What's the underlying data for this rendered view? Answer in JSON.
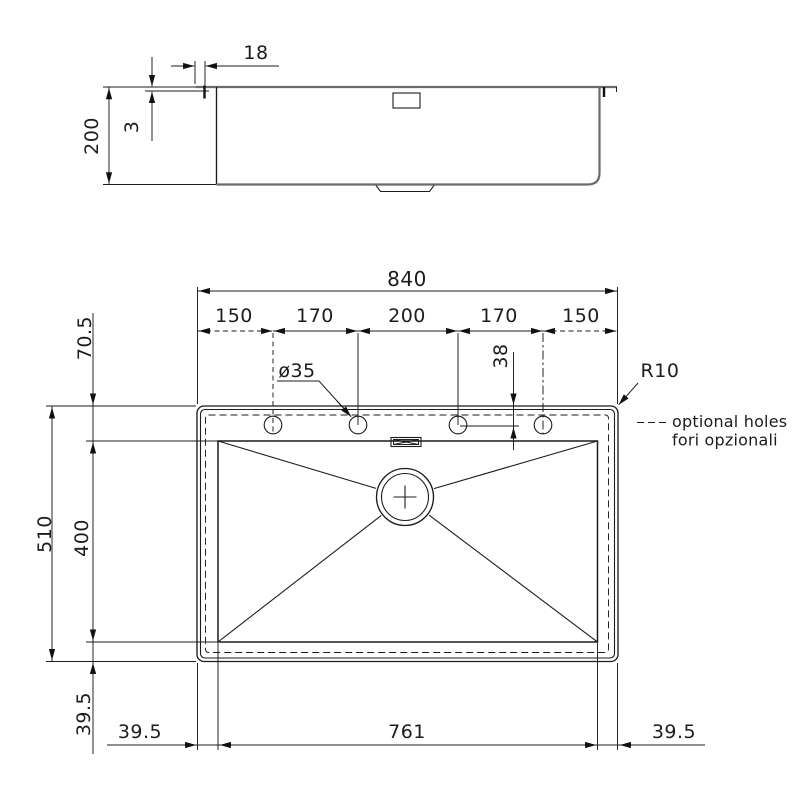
{
  "views": {
    "side": {
      "flange_width": "18",
      "flange_thickness": "3",
      "depth": "200"
    },
    "plan": {
      "overall_width": "840",
      "hole_pitches": [
        "150",
        "170",
        "200",
        "170",
        "150"
      ],
      "top_to_bowl": "70.5",
      "hole_diameter": "ø35",
      "top_to_holes": "38",
      "corner_radius": "R10",
      "note_en": "optional holes",
      "note_it": "fori opzionali",
      "overall_depth": "510",
      "bowl_depth": "400",
      "bowl_to_bottom": "39.5",
      "left_margin": "39.5",
      "bowl_width": "761",
      "right_margin": "39.5"
    }
  }
}
